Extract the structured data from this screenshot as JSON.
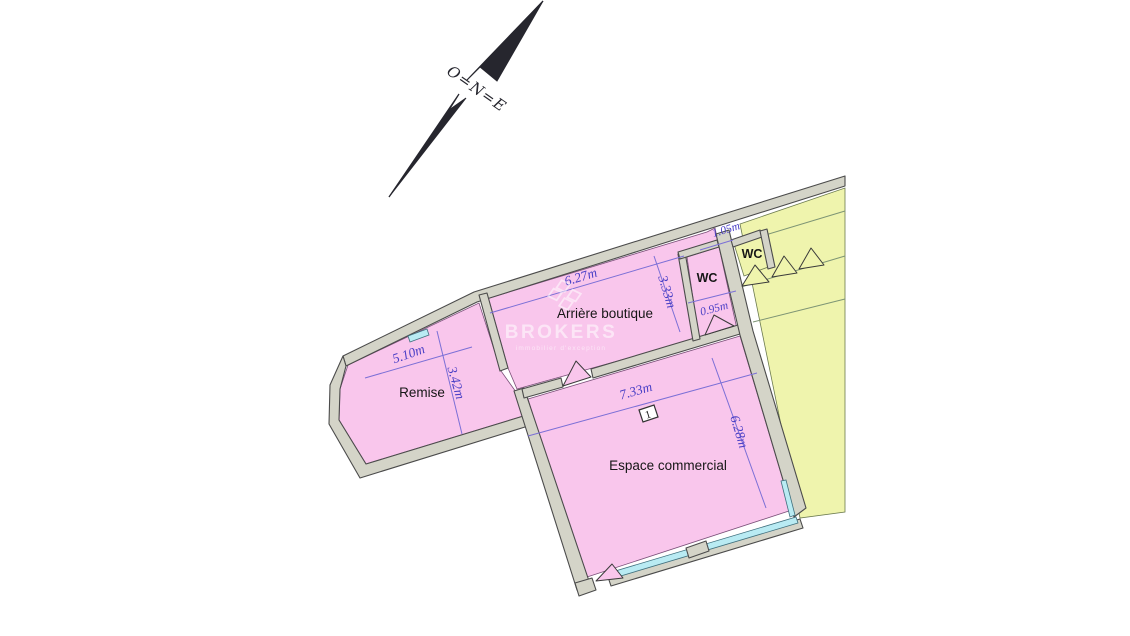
{
  "compass": {
    "label": "O=N=E"
  },
  "watermark": {
    "brand": "BROKERS",
    "tagline": "immobilier d'exception"
  },
  "labels": {
    "arriere": "Arrière boutique",
    "remise": "Remise",
    "espace": "Espace commercial",
    "wc_pink": "WC",
    "wc_yellow": "WC",
    "unit_number": "1"
  },
  "measurements": {
    "arriere_width": "6.27m",
    "arriere_depth": "3.33m",
    "remise_width": "5.10m",
    "remise_depth": "3.42m",
    "espace_width": "7.33m",
    "espace_depth": "6.28m",
    "wc_pink_width": "0.95m",
    "wc_yellow_width": "1.05m"
  },
  "colors": {
    "room_pink": "#f9c6ec",
    "room_yellow": "#eff4ad",
    "wall": "#d4d4c8",
    "glazing": "#b9ebf3",
    "dimension": "#4a3fc6",
    "label": "#161616"
  }
}
